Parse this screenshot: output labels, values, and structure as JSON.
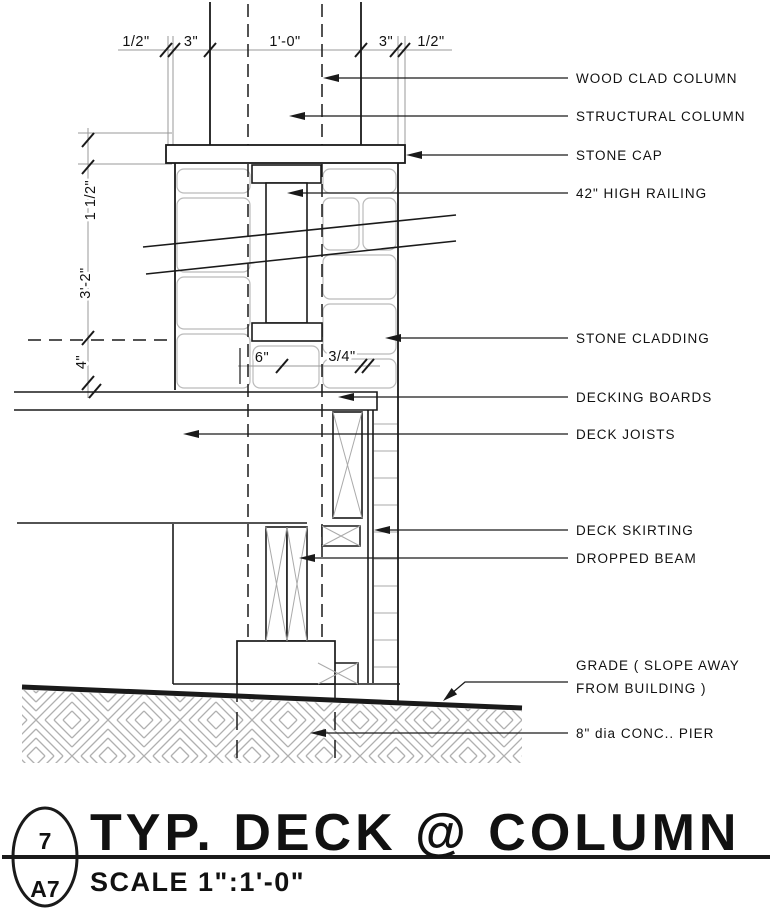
{
  "colors": {
    "ink": "#1a1a1a",
    "gray": "#999999",
    "stone": "#bbbbbb",
    "hatch": "#b0b0b0"
  },
  "callouts": [
    {
      "id": "wood-clad-column",
      "text": "WOOD CLAD COLUMN"
    },
    {
      "id": "structural-column",
      "text": "STRUCTURAL COLUMN"
    },
    {
      "id": "stone-cap",
      "text": "STONE CAP"
    },
    {
      "id": "high-railing",
      "text": "42\" HIGH RAILING"
    },
    {
      "id": "stone-cladding",
      "text": "STONE CLADDING"
    },
    {
      "id": "decking-boards",
      "text": "DECKING BOARDS"
    },
    {
      "id": "deck-joists",
      "text": "DECK JOISTS"
    },
    {
      "id": "deck-skirting",
      "text": "DECK SKIRTING"
    },
    {
      "id": "dropped-beam",
      "text": "DROPPED BEAM"
    },
    {
      "id": "grade",
      "text": "GRADE ( SLOPE AWAY",
      "text2": "FROM BUILDING )"
    },
    {
      "id": "conc-pier",
      "text": "8\" dia CONC.. PIER"
    }
  ],
  "dimensions": {
    "top": [
      "1/2\"",
      "3\"",
      "1'-0\"",
      "3\"",
      "1/2\""
    ],
    "left": [
      "1 1/2\"",
      "3'-2\"",
      "4\""
    ],
    "middle": [
      "6\"",
      "3/4\""
    ]
  },
  "title_block": {
    "detail_number": "7",
    "sheet_number": "A7",
    "title": "TYP. DECK @ COLUMN",
    "scale": "SCALE 1\":1'-0\""
  }
}
